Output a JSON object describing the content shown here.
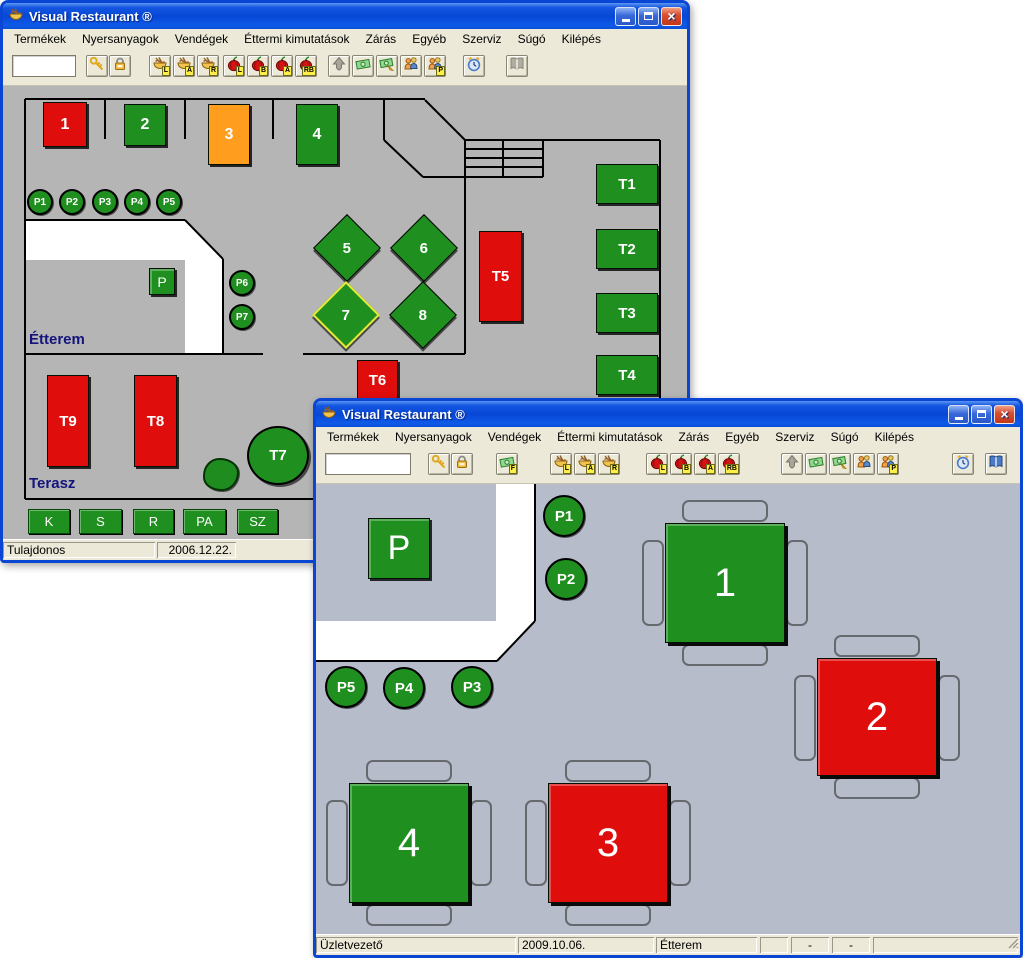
{
  "app": {
    "title": "Visual Restaurant ®"
  },
  "menu_items": [
    "Termékek",
    "Nyersanyagok",
    "Vendégek",
    "Éttermi kimutatások",
    "Zárás",
    "Egyéb",
    "Szerviz",
    "Súgó",
    "Kilépés"
  ],
  "colors": {
    "green": "#1f8f1f",
    "red": "#e00d0d",
    "orange": "#ff9d1e",
    "floor_back": "#b5b5b5",
    "floor_front": "#b7bccb",
    "chrome": "#ece9d8",
    "title_blue": "#0a50dd",
    "border_blue": "#0a46d4",
    "label_navy": "#14147c",
    "corridor_white": "#ffffff"
  },
  "windows": [
    {
      "name": "back-window",
      "title": "Visual Restaurant ®",
      "geometry": {
        "x": 0,
        "y": 0,
        "w": 690,
        "h": 563
      },
      "floor_color": "floor_back",
      "toolbar": {
        "input_value": "",
        "buttons": [
          {
            "icon": "key-icon",
            "x": 83
          },
          {
            "icon": "lock-icon",
            "x": 106
          },
          {
            "icon": "bowl-icon",
            "badge": "L",
            "x": 146
          },
          {
            "icon": "bowl-icon",
            "badge": "A",
            "x": 170
          },
          {
            "icon": "bowl-icon",
            "badge": "R",
            "x": 194
          },
          {
            "icon": "onion-icon",
            "badge": "L",
            "x": 220
          },
          {
            "icon": "onion-icon",
            "badge": "B",
            "x": 244
          },
          {
            "icon": "onion-icon",
            "badge": "A",
            "x": 268
          },
          {
            "icon": "onion-icon",
            "badge": "RB",
            "x": 292
          },
          {
            "icon": "spade-icon",
            "x": 325,
            "disabled": true
          },
          {
            "icon": "money-icon",
            "x": 349
          },
          {
            "icon": "money-pencil-icon",
            "x": 373
          },
          {
            "icon": "people-icon",
            "x": 397
          },
          {
            "icon": "people-icon",
            "badge": "P",
            "x": 421
          },
          {
            "icon": "clock-icon",
            "x": 460
          },
          {
            "icon": "book-icon",
            "x": 503,
            "disabled": true
          }
        ]
      },
      "floor": {
        "lines": [
          [
            22,
            13,
            422,
            13
          ],
          [
            102,
            13,
            102,
            53
          ],
          [
            182,
            13,
            182,
            53
          ],
          [
            270,
            13,
            270,
            53
          ],
          [
            381,
            14,
            381,
            54
          ],
          [
            381,
            54,
            420,
            91
          ],
          [
            422,
            14,
            462,
            54
          ],
          [
            462,
            54,
            657,
            54
          ],
          [
            500,
            54,
            500,
            91
          ],
          [
            540,
            54,
            540,
            91
          ],
          [
            462,
            63,
            540,
            63
          ],
          [
            462,
            72,
            540,
            72
          ],
          [
            462,
            81,
            540,
            81
          ],
          [
            420,
            91,
            540,
            91
          ],
          [
            657,
            54,
            657,
            413
          ],
          [
            22,
            13,
            22,
            413
          ],
          [
            22,
            413,
            657,
            413
          ],
          [
            22,
            268,
            260,
            268
          ],
          [
            300,
            268,
            462,
            268
          ],
          [
            462,
            54,
            462,
            268
          ],
          [
            22,
            134,
            182,
            134
          ],
          [
            182,
            134,
            220,
            173
          ],
          [
            220,
            173,
            220,
            268
          ]
        ],
        "corridor_points": "22,134 182,134 220,173 220,268 182,268 182,174 22,174",
        "objects": [
          {
            "type": "table",
            "label": "1",
            "x": 40,
            "y": 16,
            "w": 44,
            "h": 45,
            "color": "red",
            "font": 16
          },
          {
            "type": "table",
            "label": "2",
            "x": 121,
            "y": 18,
            "w": 42,
            "h": 42,
            "color": "green",
            "font": 16
          },
          {
            "type": "table",
            "label": "3",
            "x": 205,
            "y": 18,
            "w": 42,
            "h": 61,
            "color": "orange",
            "font": 16
          },
          {
            "type": "table",
            "label": "4",
            "x": 293,
            "y": 18,
            "w": 42,
            "h": 61,
            "color": "green",
            "font": 16
          },
          {
            "type": "circle",
            "label": "P1",
            "x": 24,
            "y": 103,
            "d": 26,
            "font": 10
          },
          {
            "type": "circle",
            "label": "P2",
            "x": 56,
            "y": 103,
            "d": 26,
            "font": 10
          },
          {
            "type": "circle",
            "label": "P3",
            "x": 89,
            "y": 103,
            "d": 26,
            "font": 10
          },
          {
            "type": "circle",
            "label": "P4",
            "x": 121,
            "y": 103,
            "d": 26,
            "font": 10
          },
          {
            "type": "circle",
            "label": "P5",
            "x": 153,
            "y": 103,
            "d": 26,
            "font": 10
          },
          {
            "type": "square",
            "label": "P",
            "x": 146,
            "y": 182,
            "w": 26,
            "h": 27,
            "font": 14
          },
          {
            "type": "circle",
            "label": "P6",
            "x": 226,
            "y": 184,
            "d": 26,
            "font": 10
          },
          {
            "type": "circle",
            "label": "P7",
            "x": 226,
            "y": 218,
            "d": 26,
            "font": 10
          },
          {
            "type": "diamond",
            "label": "5",
            "x": 320,
            "y": 138,
            "s": 48
          },
          {
            "type": "diamond",
            "label": "6",
            "x": 397,
            "y": 138,
            "s": 48
          },
          {
            "type": "diamond",
            "label": "7",
            "x": 319,
            "y": 205,
            "s": 48,
            "selected": true
          },
          {
            "type": "diamond",
            "label": "8",
            "x": 396,
            "y": 205,
            "s": 48
          },
          {
            "type": "table",
            "label": "T5",
            "x": 476,
            "y": 145,
            "w": 43,
            "h": 91,
            "color": "red",
            "font": 15
          },
          {
            "type": "table",
            "label": "T1",
            "x": 593,
            "y": 78,
            "w": 62,
            "h": 40,
            "color": "green",
            "font": 15
          },
          {
            "type": "table",
            "label": "T2",
            "x": 593,
            "y": 143,
            "w": 62,
            "h": 40,
            "color": "green",
            "font": 15
          },
          {
            "type": "table",
            "label": "T3",
            "x": 593,
            "y": 207,
            "w": 62,
            "h": 40,
            "color": "green",
            "font": 15
          },
          {
            "type": "table",
            "label": "T4",
            "x": 593,
            "y": 269,
            "w": 62,
            "h": 40,
            "color": "green",
            "font": 15
          },
          {
            "type": "table",
            "label": "T6",
            "x": 354,
            "y": 274,
            "w": 41,
            "h": 40,
            "color": "red",
            "font": 15
          },
          {
            "type": "table",
            "label": "T9",
            "x": 44,
            "y": 289,
            "w": 42,
            "h": 92,
            "color": "red",
            "font": 15
          },
          {
            "type": "table",
            "label": "T8",
            "x": 131,
            "y": 289,
            "w": 43,
            "h": 92,
            "color": "red",
            "font": 15
          },
          {
            "type": "bush",
            "x": 200,
            "y": 372,
            "w": 36,
            "h": 33
          },
          {
            "type": "circle-table",
            "label": "T7",
            "x": 244,
            "y": 340,
            "w": 62,
            "h": 59
          },
          {
            "type": "room-label",
            "text": "Étterem",
            "x": 26,
            "y": 245
          },
          {
            "type": "room-label",
            "text": "Terasz",
            "x": 26,
            "y": 389
          },
          {
            "type": "button",
            "label": "K",
            "x": 25,
            "y": 423,
            "w": 42,
            "h": 25
          },
          {
            "type": "button",
            "label": "S",
            "x": 76,
            "y": 423,
            "w": 43,
            "h": 25
          },
          {
            "type": "button",
            "label": "R",
            "x": 130,
            "y": 423,
            "w": 41,
            "h": 25
          },
          {
            "type": "button",
            "label": "PA",
            "x": 180,
            "y": 423,
            "w": 43,
            "h": 25
          },
          {
            "type": "button",
            "label": "SZ",
            "x": 234,
            "y": 423,
            "w": 41,
            "h": 25
          }
        ]
      },
      "status": [
        {
          "text": "Tulajdonos",
          "x": 0,
          "w": 152
        },
        {
          "text": "2006.12.22.",
          "x": 154,
          "w": 79,
          "align": "right"
        }
      ]
    },
    {
      "name": "front-window",
      "title": "Visual Restaurant ®",
      "geometry": {
        "x": 313,
        "y": 398,
        "w": 710,
        "h": 560
      },
      "floor_color": "floor_front",
      "toolbar": {
        "input_value": "",
        "buttons": [
          {
            "icon": "key-icon",
            "x": 112
          },
          {
            "icon": "lock-icon",
            "x": 135
          },
          {
            "icon": "money-icon",
            "badge": "F",
            "x": 180
          },
          {
            "icon": "bowl-icon",
            "badge": "L",
            "x": 234
          },
          {
            "icon": "bowl-icon",
            "badge": "A",
            "x": 258
          },
          {
            "icon": "bowl-icon",
            "badge": "R",
            "x": 282
          },
          {
            "icon": "onion-icon",
            "badge": "L",
            "x": 330
          },
          {
            "icon": "onion-icon",
            "badge": "B",
            "x": 354
          },
          {
            "icon": "onion-icon",
            "badge": "A",
            "x": 378
          },
          {
            "icon": "onion-icon",
            "badge": "RB",
            "x": 402
          },
          {
            "icon": "spade-icon",
            "x": 465,
            "disabled": true
          },
          {
            "icon": "money-icon",
            "x": 489
          },
          {
            "icon": "money-pencil-icon",
            "x": 513
          },
          {
            "icon": "people-icon",
            "x": 537
          },
          {
            "icon": "people-icon",
            "badge": "P",
            "x": 561
          },
          {
            "icon": "clock-icon",
            "x": 636
          },
          {
            "icon": "book-icon",
            "x": 669
          }
        ]
      },
      "floor": {
        "lines": [
          [
            219,
            0,
            219,
            137
          ],
          [
            219,
            137,
            181,
            177
          ],
          [
            181,
            177,
            0,
            177
          ]
        ],
        "corridor_points": "0,137 180,137 180,0 219,0 219,137 181,177 0,177",
        "objects": [
          {
            "type": "square",
            "label": "P",
            "x": 52,
            "y": 34,
            "w": 62,
            "h": 61,
            "font": 34
          },
          {
            "type": "circle",
            "label": "P1",
            "x": 227,
            "y": 11,
            "d": 42,
            "font": 15
          },
          {
            "type": "circle",
            "label": "P2",
            "x": 229,
            "y": 74,
            "d": 42,
            "font": 15
          },
          {
            "type": "circle",
            "label": "P3",
            "x": 135,
            "y": 182,
            "d": 42,
            "font": 15
          },
          {
            "type": "circle",
            "label": "P4",
            "x": 67,
            "y": 183,
            "d": 42,
            "font": 15
          },
          {
            "type": "circle",
            "label": "P5",
            "x": 9,
            "y": 182,
            "d": 42,
            "font": 15
          },
          {
            "type": "bigtable",
            "label": "1",
            "x": 349,
            "y": 39,
            "w": 120,
            "h": 120,
            "color": "green",
            "font": 40
          },
          {
            "type": "bigtable",
            "label": "2",
            "x": 501,
            "y": 174,
            "w": 120,
            "h": 118,
            "color": "red",
            "font": 40
          },
          {
            "type": "bigtable",
            "label": "3",
            "x": 232,
            "y": 299,
            "w": 120,
            "h": 120,
            "color": "red",
            "font": 40
          },
          {
            "type": "bigtable",
            "label": "4",
            "x": 33,
            "y": 299,
            "w": 120,
            "h": 120,
            "color": "green",
            "font": 40
          }
        ]
      },
      "status": [
        {
          "text": "Üzletvezető",
          "x": 0,
          "w": 200
        },
        {
          "text": "2009.10.06.",
          "x": 202,
          "w": 136
        },
        {
          "text": "Étterem",
          "x": 340,
          "w": 101
        },
        {
          "text": "",
          "x": 444,
          "w": 28
        },
        {
          "text": "-",
          "x": 475,
          "w": 38,
          "align": "center"
        },
        {
          "text": "-",
          "x": 516,
          "w": 38,
          "align": "center"
        },
        {
          "text": "",
          "x": 557,
          "w": 145,
          "grip": true
        }
      ]
    }
  ]
}
